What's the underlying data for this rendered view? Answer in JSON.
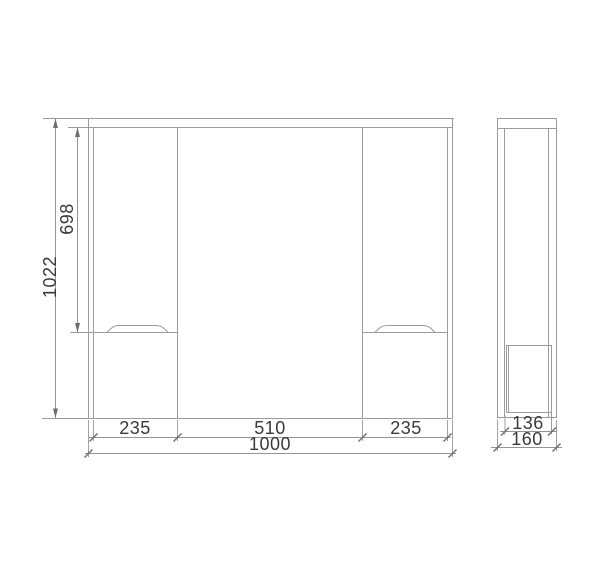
{
  "drawing": {
    "type": "cabinet-dimension-drawing",
    "front_view": {
      "total_height": "1022",
      "upper_section_height": "698",
      "left_door_width": "235",
      "mirror_width": "510",
      "right_door_width": "235",
      "total_width": "1000"
    },
    "side_view": {
      "door_depth": "136",
      "total_depth": "160"
    }
  },
  "colors": {
    "background": "#ffffff",
    "drawing_line": "#9c9c9c",
    "dimension_line": "#949494",
    "tick_and_arrow": "#6e6e6e",
    "dimension_text": "#3a3a3a"
  }
}
